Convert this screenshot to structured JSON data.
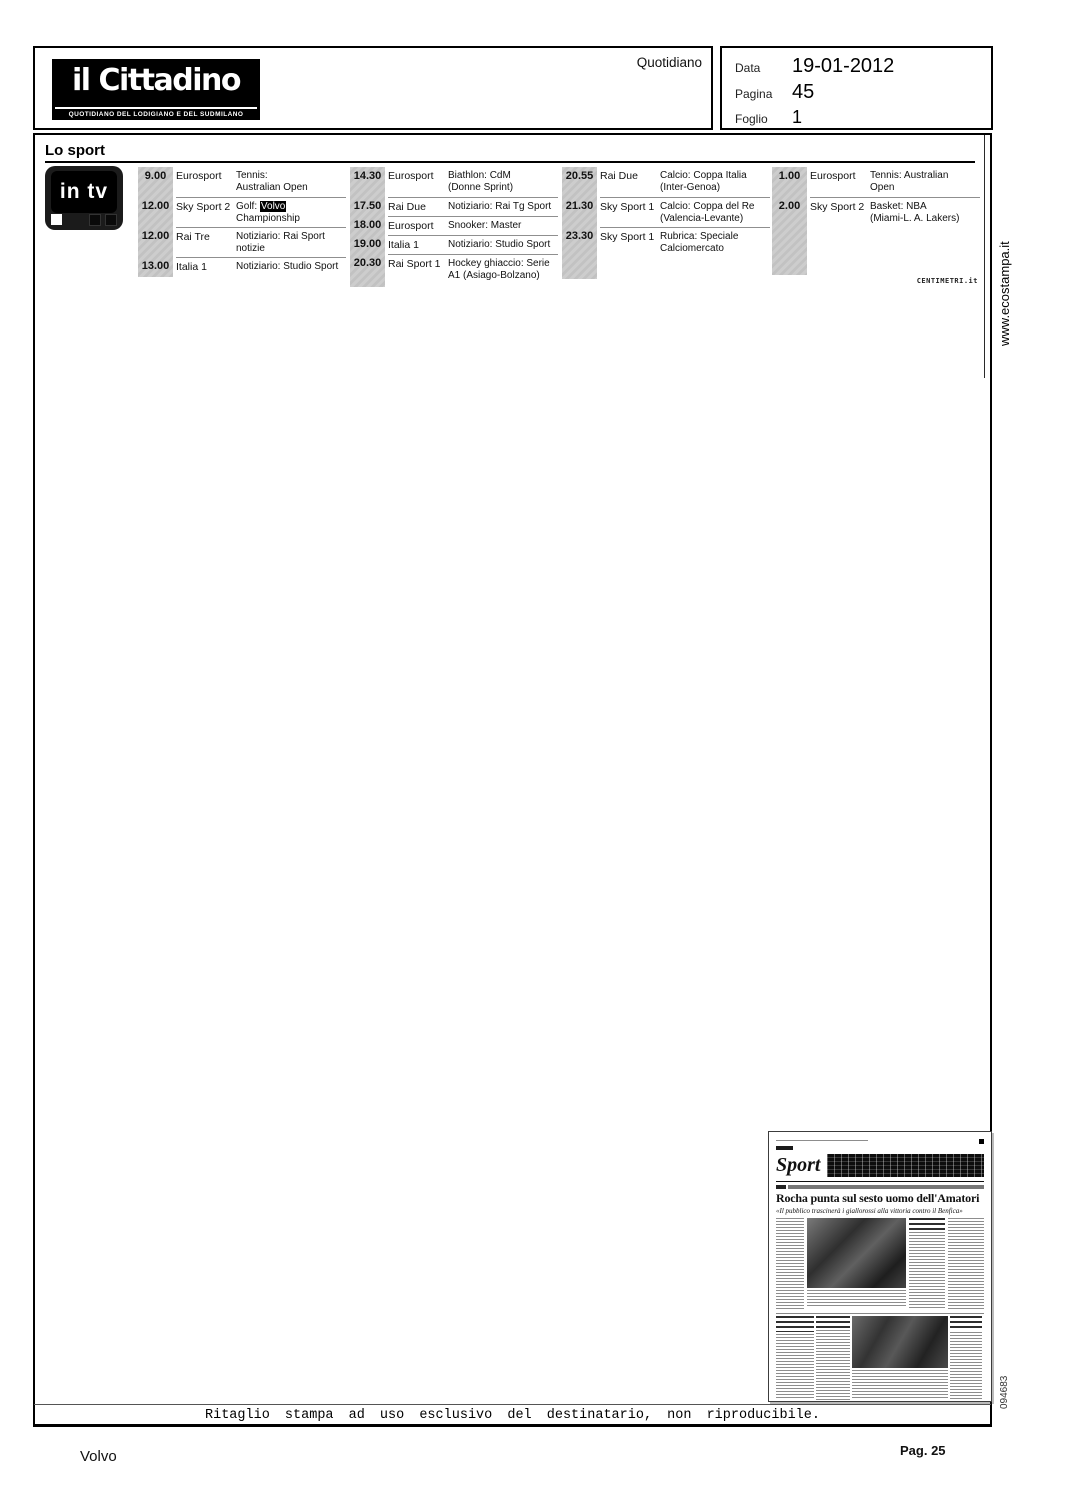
{
  "header": {
    "logo_title": "il Cittadino",
    "logo_subtitle": "QUOTIDIANO DEL LODIGIANO E DEL SUDMILANO",
    "type_label": "Quotidiano",
    "meta": {
      "data_label": "Data",
      "data_value": "19-01-2012",
      "pagina_label": "Pagina",
      "pagina_value": "45",
      "foglio_label": "Foglio",
      "foglio_value": "1"
    }
  },
  "side": {
    "url": "www.ecostampa.it",
    "code": "094683"
  },
  "sport": {
    "section_title": "Lo sport",
    "tv_logo_label": "in tv",
    "credit": "CENTIMETRI.it",
    "columns": [
      {
        "rows": [
          {
            "time": "9.00",
            "channel": "Eurosport",
            "program": "Tennis:\nAustralian Open"
          },
          {
            "time": "12.00",
            "channel": "Sky Sport 2",
            "program_prefix": "Golf: ",
            "program_highlight": "Volvo",
            "program_suffix": "\nChampionship"
          },
          {
            "time": "12.00",
            "channel": "Rai Tre",
            "program": "Notiziario: Rai Sport\nnotizie"
          },
          {
            "time": "13.00",
            "channel": "Italia 1",
            "program": "Notiziario: Studio Sport"
          }
        ]
      },
      {
        "rows": [
          {
            "time": "14.30",
            "channel": "Eurosport",
            "program": "Biathlon: CdM\n(Donne Sprint)"
          },
          {
            "time": "17.50",
            "channel": "Rai Due",
            "program": "Notiziario: Rai Tg Sport"
          },
          {
            "time": "18.00",
            "channel": "Eurosport",
            "program": "Snooker: Master"
          },
          {
            "time": "19.00",
            "channel": "Italia 1",
            "program": "Notiziario: Studio Sport"
          },
          {
            "time": "20.30",
            "channel": "Rai Sport 1",
            "program": "Hockey ghiaccio: Serie\nA1 (Asiago-Bolzano)"
          }
        ]
      },
      {
        "rows": [
          {
            "time": "20.55",
            "channel": "Rai Due",
            "program": "Calcio: Coppa Italia\n(Inter-Genoa)"
          },
          {
            "time": "21.30",
            "channel": "Sky Sport 1",
            "program": "Calcio: Coppa del Re\n(Valencia-Levante)"
          },
          {
            "time": "23.30",
            "channel": "Sky Sport 1",
            "program": "Rubrica: Speciale\nCalciomercato"
          }
        ]
      },
      {
        "rows": [
          {
            "time": "1.00",
            "channel": "Eurosport",
            "program": "Tennis: Australian\nOpen"
          },
          {
            "time": "2.00",
            "channel": "Sky Sport 2",
            "program": "Basket: NBA\n(Miami-L. A. Lakers)"
          }
        ]
      }
    ]
  },
  "thumbnail": {
    "section_title": "Sport",
    "headline": "Rocha punta sul sesto uomo dell'Amatori",
    "subhead": "«Il pubblico trascinerà i giallorossi alla vittoria contro il Benfica»"
  },
  "footer": {
    "disclaimer": "Ritaglio stampa ad uso esclusivo del destinatario, non riproducibile.",
    "subject": "Volvo",
    "page_ref": "Pag. 25"
  },
  "colors": {
    "highlight_bg": "#000000",
    "time_strip": "#c9c9c9"
  }
}
